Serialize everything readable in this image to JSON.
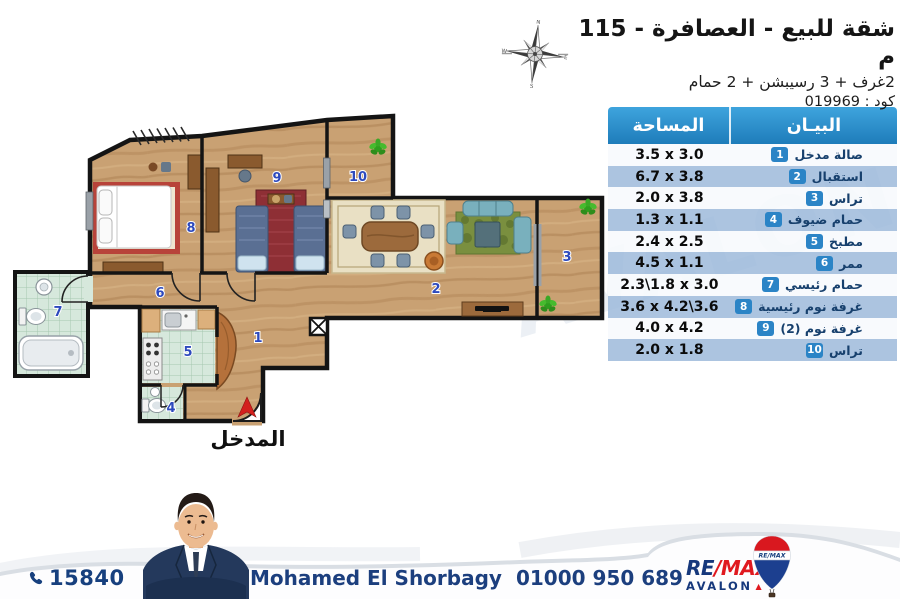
{
  "header": {
    "title": "شقة للبيع - العصافرة - 115 م",
    "subtitle": "2غرف + 3 رسيبشن + 2 حمام",
    "code": "كود : 019969"
  },
  "table": {
    "area_header": "المساحة",
    "desc_header": "البيـان",
    "rows": [
      {
        "no": "1",
        "name": "صالة مدخل",
        "area": "3.5 x 3.0"
      },
      {
        "no": "2",
        "name": "استقبال",
        "area": "6.7 x 3.8"
      },
      {
        "no": "3",
        "name": "تراس",
        "area": "2.0 x 3.8"
      },
      {
        "no": "4",
        "name": "حمام ضيوف",
        "area": "1.3 x 1.1"
      },
      {
        "no": "5",
        "name": "مطبخ",
        "area": "2.4 x 2.5"
      },
      {
        "no": "6",
        "name": "ممر",
        "area": "4.5 x 1.1"
      },
      {
        "no": "7",
        "name": "حمام رئيسي",
        "area": "2.3\\1.8 x 3.0"
      },
      {
        "no": "8",
        "name": "غرفة نوم رئيسية",
        "area": "3.6 x 4.2\\3.6"
      },
      {
        "no": "9",
        "name": "غرفة نوم (2)",
        "area": "4.0 x 4.2"
      },
      {
        "no": "10",
        "name": "تراس",
        "area": "2.0 x 1.8"
      }
    ]
  },
  "plan": {
    "rooms": [
      "1",
      "2",
      "3",
      "4",
      "5",
      "6",
      "7",
      "8",
      "9",
      "10"
    ],
    "entrance_label": "المدخل"
  },
  "footer": {
    "hotline": "15840",
    "agent_name": "Mohamed El Shorbagy",
    "agent_phone": "01000 950 689",
    "brand_re": "RE",
    "brand_slash": "/",
    "brand_max": "MAX",
    "office": "AVALON",
    "balloon_text": "RE/MAX"
  },
  "watermark": "AVALON",
  "colors": {
    "accent_blue": "#2b84c6",
    "navy": "#17407e",
    "red": "#e0191f",
    "row_alt": "#b7cce4"
  }
}
